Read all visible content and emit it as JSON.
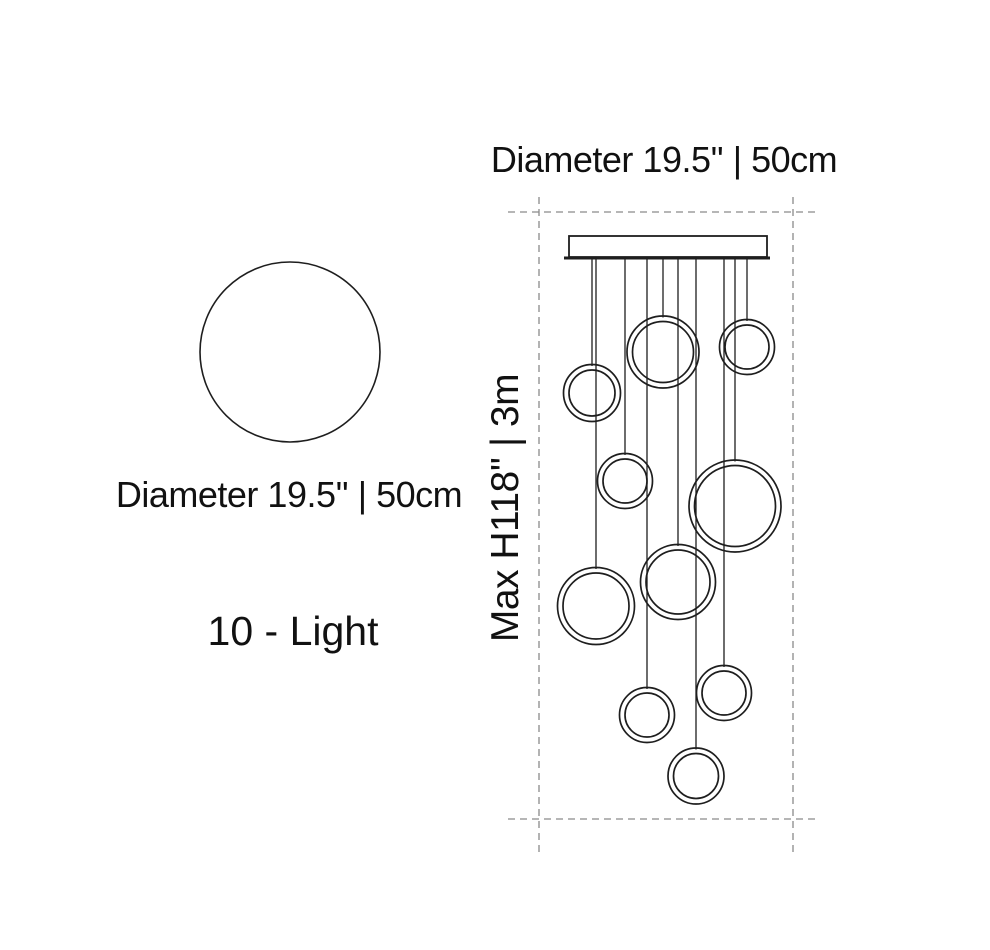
{
  "labels": {
    "top_diameter": "Diameter 19.5'' | 50cm",
    "left_diameter": "Diameter 19.5'' | 50cm",
    "light_count": "10 - Light",
    "max_height": "Max H118'' | 3m"
  },
  "colors": {
    "background": "#ffffff",
    "line": "#1e1e1e",
    "dashed": "#8a8a8a",
    "text": "#111111"
  },
  "diagram": {
    "left_circle": {
      "cx": 290,
      "cy": 352,
      "r": 90
    },
    "canopy": {
      "x": 569,
      "y": 236,
      "width": 198,
      "height": 21
    },
    "baseplate": {
      "x": 564,
      "y": 256.5,
      "width": 206,
      "height": 3
    },
    "cord_top_y": 259,
    "dashed_bounds": {
      "left_x": 539,
      "right_x": 793,
      "top_y": 212,
      "bottom_y": 819,
      "vert_top": 197,
      "vert_bottom": 852,
      "horiz_left": 508,
      "horiz_right": 817
    },
    "ring_gap": 5.5,
    "rings": [
      {
        "cx": 663,
        "cy": 352,
        "r": 36
      },
      {
        "cx": 747,
        "cy": 347,
        "r": 27.5
      },
      {
        "cx": 592,
        "cy": 393,
        "r": 28.5
      },
      {
        "cx": 625,
        "cy": 481,
        "r": 27.5
      },
      {
        "cx": 735,
        "cy": 506,
        "r": 46
      },
      {
        "cx": 596,
        "cy": 606,
        "r": 38.5
      },
      {
        "cx": 678,
        "cy": 582,
        "r": 37.5
      },
      {
        "cx": 647,
        "cy": 715,
        "r": 27.5
      },
      {
        "cx": 724,
        "cy": 693,
        "r": 27.5
      },
      {
        "cx": 696,
        "cy": 776,
        "r": 28
      }
    ]
  }
}
